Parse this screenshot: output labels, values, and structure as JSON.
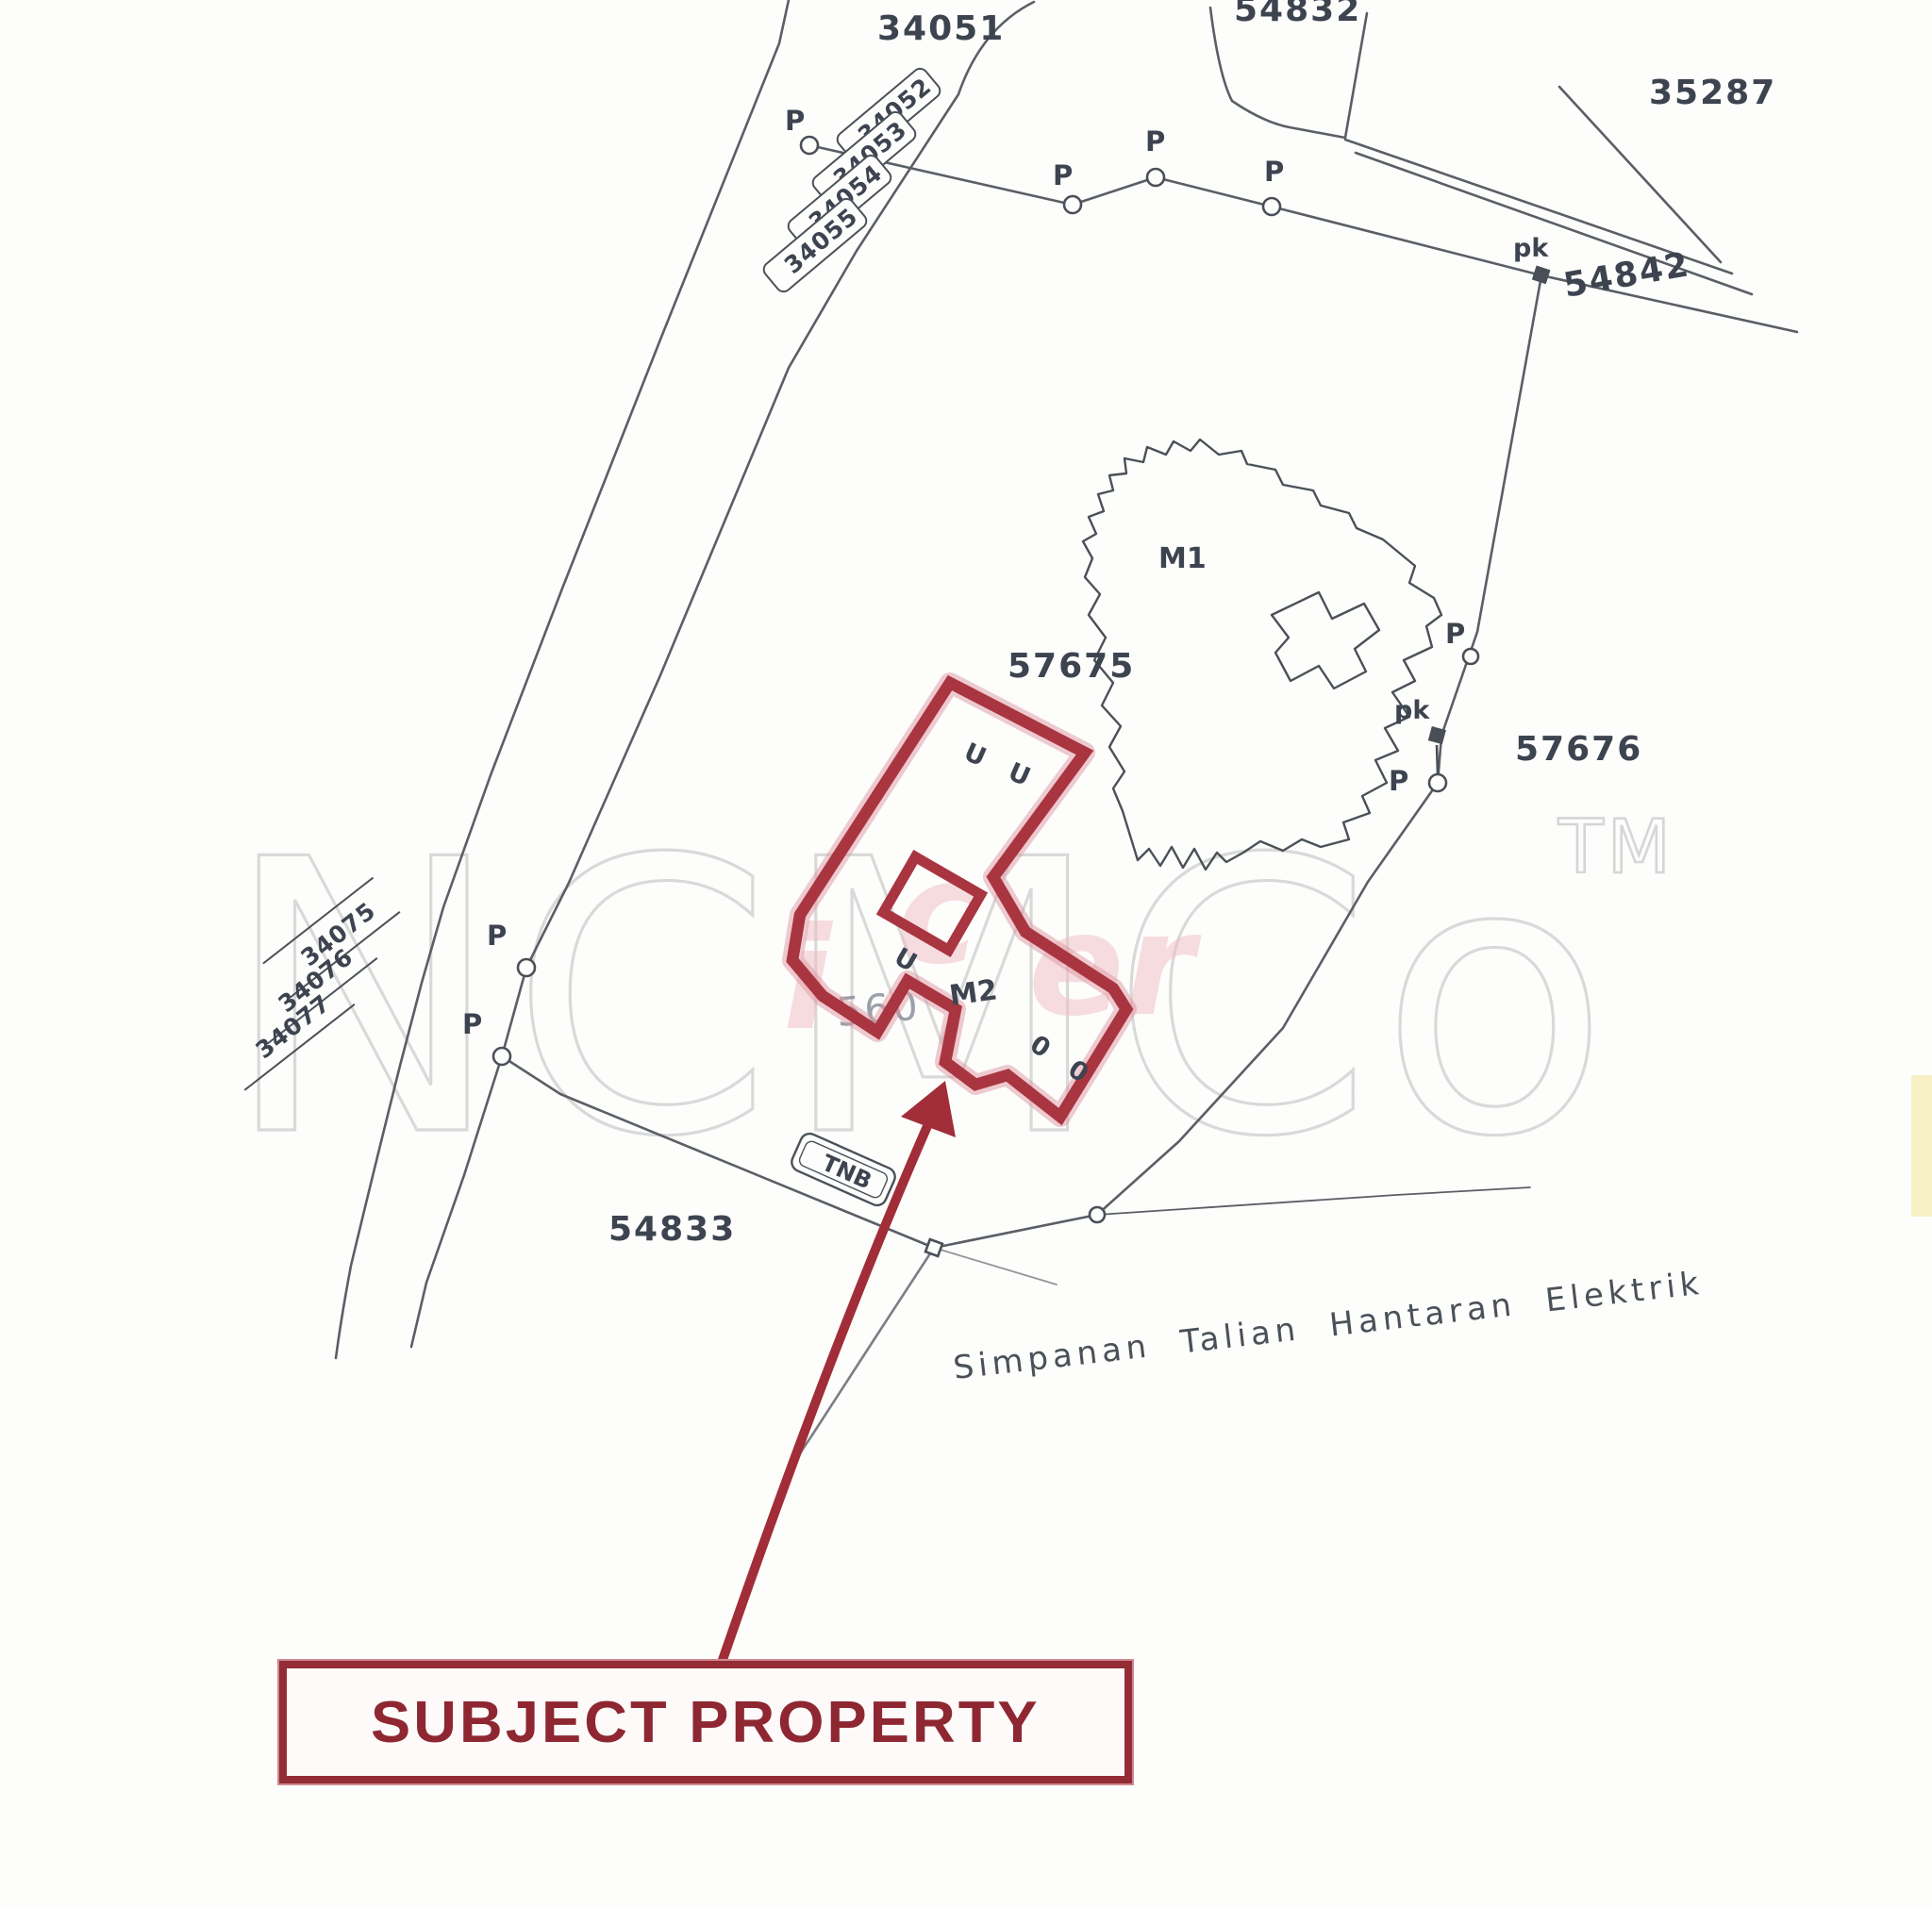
{
  "watermark": {
    "brand": "NCMCo",
    "tm": "TM",
    "fragment": "560"
  },
  "parcels": {
    "p34051": "34051",
    "p54832": "54832",
    "p35287": "35287",
    "p54842": "54842",
    "p57675": "57675",
    "p57676": "57676",
    "p54833": "54833"
  },
  "parcel_stack_top": {
    "a": "34052",
    "b": "34053",
    "c": "34054",
    "d": "34055"
  },
  "parcel_stack_left": {
    "a": "34075",
    "b": "34076",
    "c": "34077"
  },
  "buildings": {
    "m1": "M1",
    "m2": "M2"
  },
  "markers": {
    "p": "P",
    "pk": "pk"
  },
  "utility": {
    "box": "TNB",
    "note": "Simpanan Talian Hantaran Elektrik"
  },
  "unit_marks": {
    "top": "U U",
    "mid": "U",
    "bottom": "0 0"
  },
  "callout": {
    "label": "SUBJECT PROPERTY"
  },
  "colors": {
    "subject_outline": "#a93540",
    "subject_halo": "#dd98a1",
    "callout_red": "#942c36",
    "line_gray": "#5a5f66",
    "label_ink": "#3d4450",
    "watermark_gray": "#d9d9d9"
  }
}
